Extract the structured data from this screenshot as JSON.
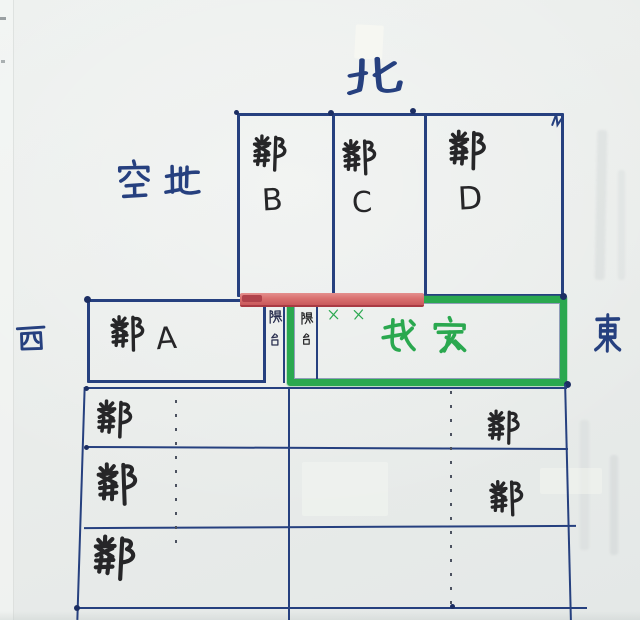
{
  "compass": {
    "north": "北",
    "west": "西",
    "east": "東"
  },
  "labels": {
    "open_land": "空地"
  },
  "top_row": [
    {
      "name": "鄰",
      "unit": "B"
    },
    {
      "name": "鄰",
      "unit": "C"
    },
    {
      "name": "鄰",
      "unit": "D"
    }
  ],
  "middle_row": {
    "neighbor_a": "鄰A",
    "balcony_left": "陽台",
    "balcony_right": "陽台",
    "x_marks": "✗✗",
    "my_home": "我家"
  },
  "lower_grid": {
    "left_labels": [
      "鄰",
      "鄰",
      "鄰"
    ],
    "right_labels": [
      "鄰",
      "鄰"
    ]
  },
  "colors": {
    "ink_blue": "#26407f",
    "ink_black": "#262628",
    "marker_green": "#2aa84f",
    "marker_red": "#d9706f",
    "paper": "#e9ecea"
  }
}
